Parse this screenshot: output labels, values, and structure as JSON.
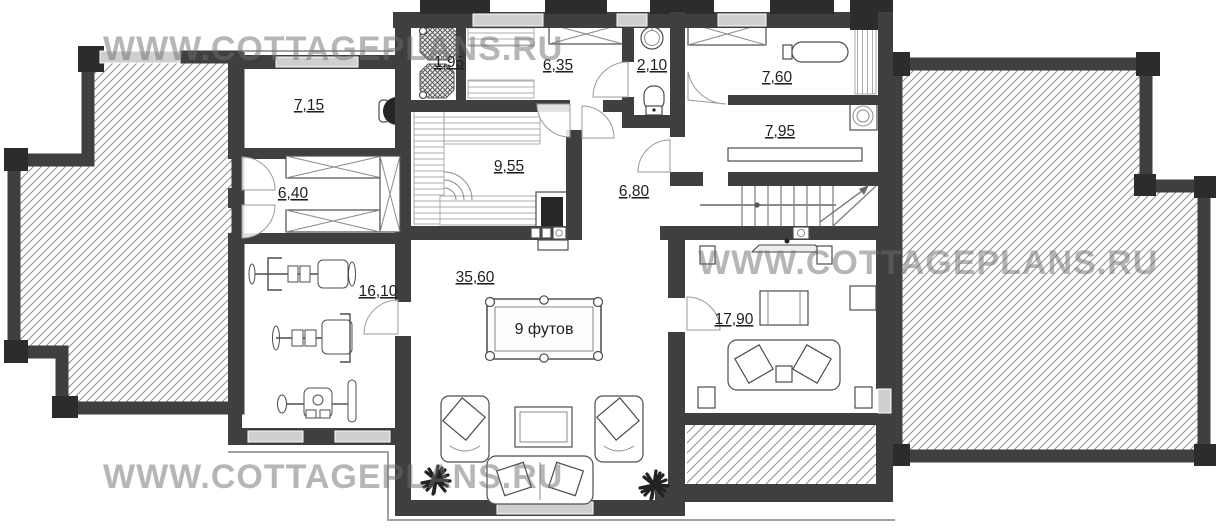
{
  "watermarks": [
    "WWW.COTTAGEPLANS.RU",
    "WWW.COTTAGEPLANS.RU",
    "WWW.COTTAGEPLANS.RU"
  ],
  "rooms": [
    {
      "id": "room-7-15",
      "area": "7,15"
    },
    {
      "id": "room-1-95",
      "area": "1,95"
    },
    {
      "id": "room-6-35",
      "area": "6,35"
    },
    {
      "id": "room-2-10",
      "area": "2,10"
    },
    {
      "id": "room-7-60",
      "area": "7,60"
    },
    {
      "id": "room-7-95",
      "area": "7,95"
    },
    {
      "id": "room-6-40",
      "area": "6,40"
    },
    {
      "id": "room-9-55",
      "area": "9,55"
    },
    {
      "id": "room-6-80",
      "area": "6,80"
    },
    {
      "id": "room-16-10",
      "area": "16,10"
    },
    {
      "id": "room-35-60",
      "area": "35,60"
    },
    {
      "id": "room-17-90",
      "area": "17,90"
    }
  ],
  "billiard_table": {
    "label": "9 футов"
  },
  "colors": {
    "wall": "#3f3f3f",
    "wall_dark": "#2c2c2c",
    "window": "#cfcfcf",
    "hatch_line": "#8f8f8f",
    "label_text": "#1f1f1f",
    "furniture_stroke": "#4d4d4d",
    "watermark": "rgba(110,110,110,0.5)"
  }
}
